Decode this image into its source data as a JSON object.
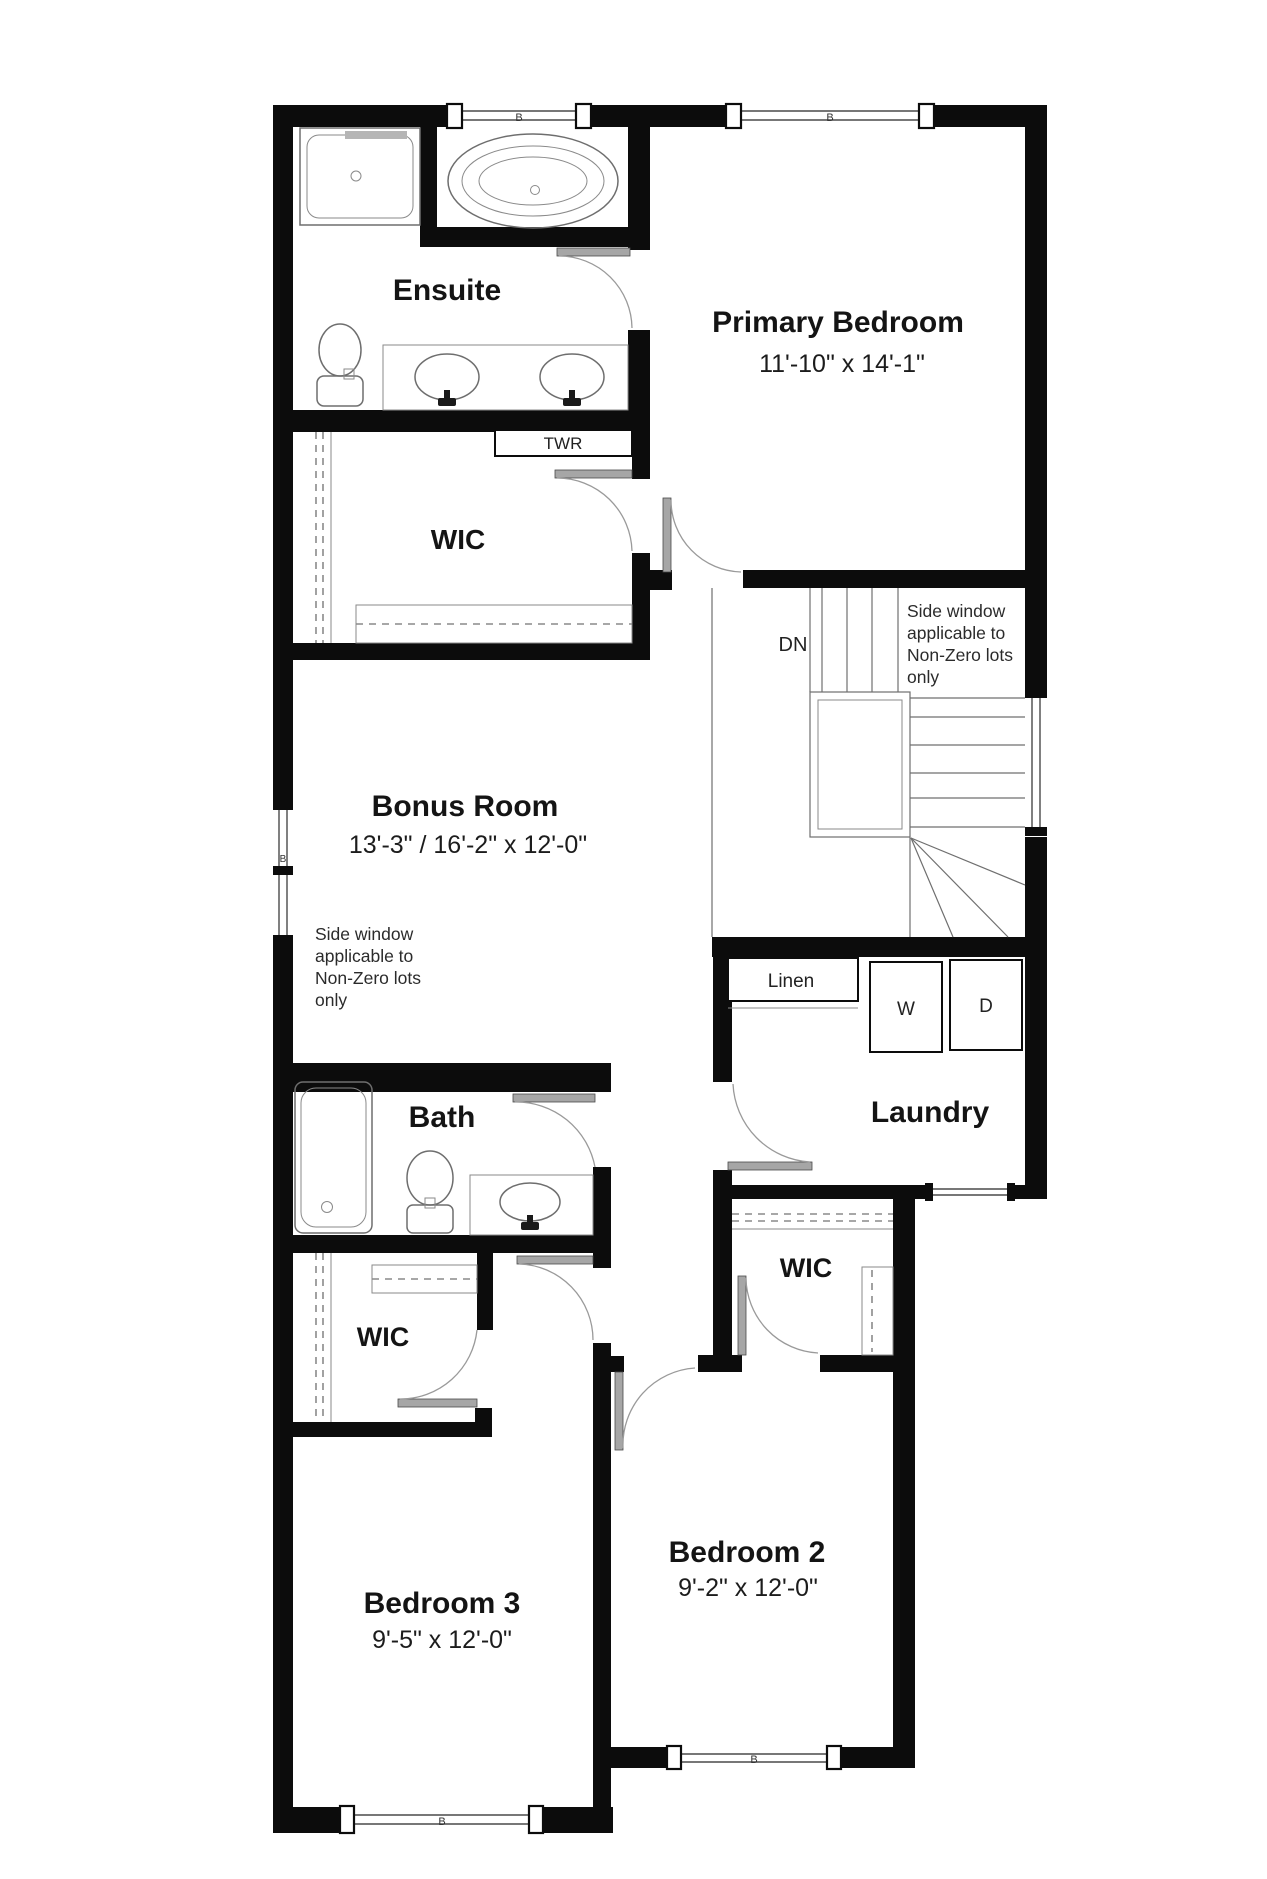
{
  "colors": {
    "wall": "#0c0c0c",
    "background": "#ffffff",
    "fixture_line": "#6e6e6e",
    "door_gray": "#a6a6a6",
    "text": "#141414"
  },
  "window_tag": "B",
  "rooms": {
    "ensuite": {
      "label": "Ensuite"
    },
    "primary_bedroom": {
      "label": "Primary Bedroom",
      "dimensions": "11'-10\" x 14'-1\""
    },
    "wic_primary": {
      "label": "WIC"
    },
    "towel_cabinet": {
      "label": "TWR"
    },
    "bonus_room": {
      "label": "Bonus Room",
      "dimensions": "13'-3\" / 16'-2\" x 12'-0\""
    },
    "stairs": {
      "label": "DN"
    },
    "laundry": {
      "label": "Laundry",
      "linen": "Linen",
      "washer": "W",
      "dryer": "D"
    },
    "bath": {
      "label": "Bath"
    },
    "wic_bedroom3": {
      "label": "WIC"
    },
    "wic_bedroom2": {
      "label": "WIC"
    },
    "bedroom2": {
      "label": "Bedroom 2",
      "dimensions": "9'-2\" x 12'-0\""
    },
    "bedroom3": {
      "label": "Bedroom 3",
      "dimensions": "9'-5\" x 12'-0\""
    }
  },
  "notes": {
    "side_window_right": [
      "Side window",
      "applicable to",
      "Non-Zero lots",
      "only"
    ],
    "side_window_left": [
      "Side window",
      "applicable to",
      "Non-Zero lots",
      "only"
    ]
  }
}
